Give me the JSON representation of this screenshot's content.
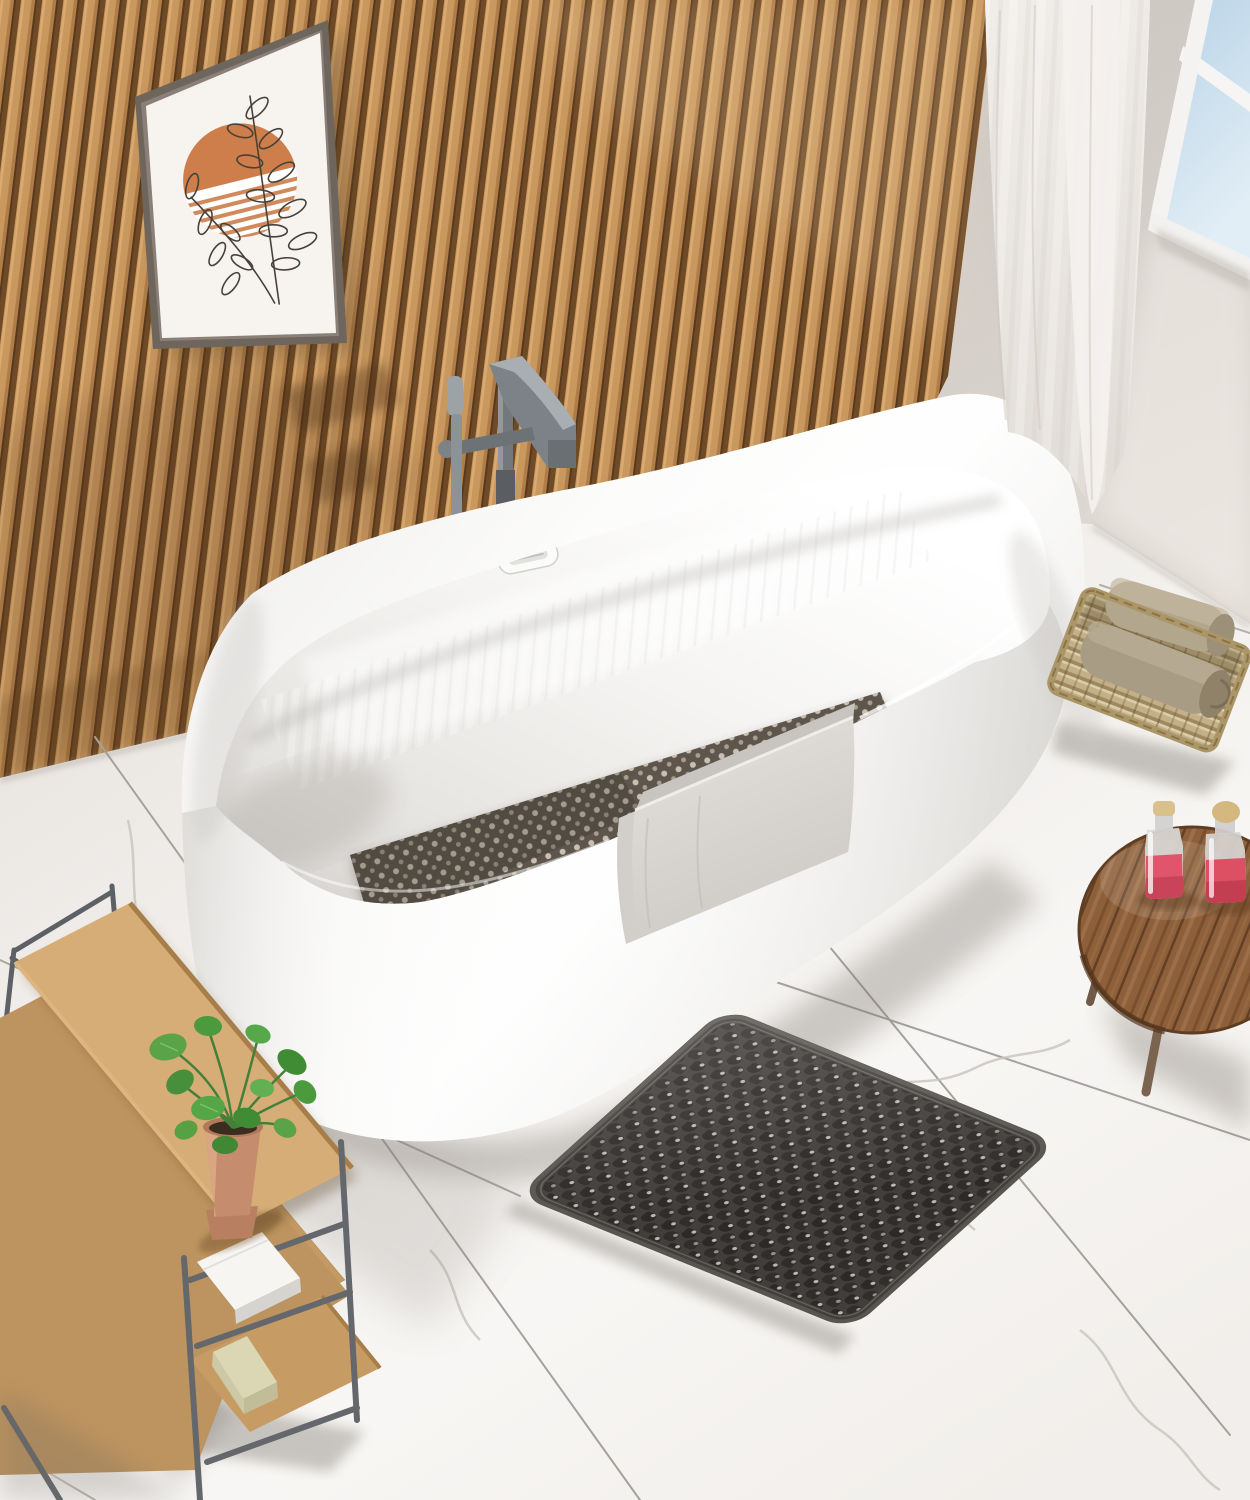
{
  "scene": {
    "type": "product-lifestyle-photo",
    "setting": "modern bathroom with freestanding tub, wood slat accent wall and marble tile floor",
    "objects": {
      "accent_wall": "vertical-wood-slat-panel-wall",
      "artwork": "framed-boho-print-orange-sun-with-line-art-leaves",
      "window": "corner-window-white-frame-blue-sky",
      "curtain": "sheer-white-floor-curtain",
      "bathtub": "white-acrylic-freestanding-oval-soaking-tub",
      "faucet": "gunmetal-freestanding-tub-filler-with-hand-shower",
      "overflow": "tub-overflow-plate",
      "tub_mat": "perforated-dark-bath-mat-inside-tub",
      "towel": "light-grey-towel-draped-over-tub-rim",
      "floor_mat": "black-rubber-suction-cup-bath-mat-on-floor",
      "basket": "wicker-basket-with-two-rolled-towels",
      "side_table": "round-wood-tripod-side-table",
      "bottles": "two-pink-soap-bottles-with-tan-caps",
      "shelf": "three-tier-wood-and-metal-bath-shelf",
      "plant": "green-potted-plant-in-terracotta-pot",
      "shelf_towel": "folded-white-towel-on-middle-shelf",
      "soap": "beige-soap-bar-on-bottom-shelf",
      "floor": "white-marble-tile-floor-with-grout-lines"
    }
  },
  "palette": {
    "wood": "#c4925a",
    "wood_gap": "#6f4a26",
    "wall": "#d5cfc9",
    "floor": "#efece9",
    "grout": "#a5a19c",
    "tub": "#fbfbfa",
    "tub_mat": "#5e564c",
    "towel": "#dcd8d3",
    "floor_mat": "#413e3b",
    "basket": "#c3b089",
    "basket_towel": "#b2a68d",
    "table_wood": "#8d5f3a",
    "bottle_liquid": "#e0556b",
    "bottle_cap": "#d9c18c",
    "plant": "#4e9a3e",
    "pot": "#c58c6d",
    "soap": "#dbd7b4",
    "metal": "#6f7378",
    "glass": "#c3dcec",
    "curtain": "#ece8e3",
    "frame": "#6e655c",
    "art_paper": "#f7f4ef",
    "art_orange": "#cd7e4b",
    "shelf_wood": "#cda26a"
  }
}
